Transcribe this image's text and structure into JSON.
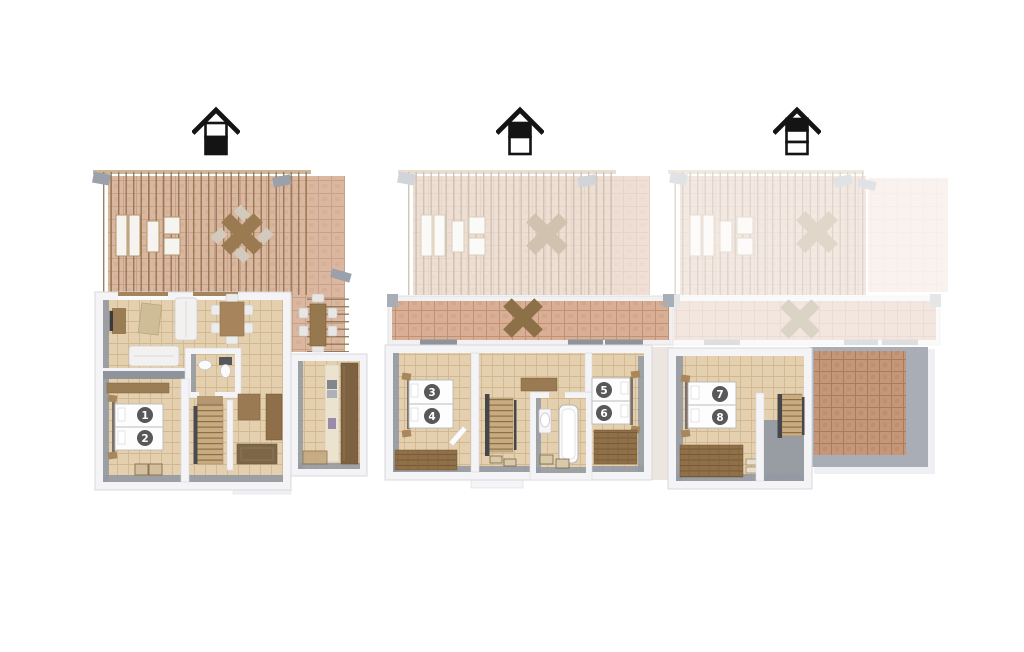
{
  "page": {
    "description": "Three-level 3D floor plan set with numbered beds"
  },
  "colors": {
    "background": "#ffffff",
    "terrace_tile": "#dcb7a0",
    "interior_tile": "#e4d0ae",
    "balcony_tile": "#d8ae94",
    "roof_tile": "#c69678",
    "wall_light": "#f4f4f6",
    "wall_shadow": "#939aa3",
    "wood": "#9a7a52",
    "wood_dark": "#7e6140",
    "pergola": "#8d744e",
    "icon_ink": "#141414",
    "marker_bg": "#58585a",
    "marker_text": "#ffffff"
  },
  "floors": [
    {
      "id": "ground-floor",
      "house_icon": {
        "levels": 2,
        "highlighted_band": "bottom",
        "band_fills": [
          "#ffffff",
          "#141414"
        ]
      },
      "beds": [
        {
          "label": "1"
        },
        {
          "label": "2"
        }
      ],
      "rooms": [
        "terrace",
        "living-room",
        "dining-area",
        "bathroom",
        "bedroom",
        "stairs",
        "hall",
        "kitchen",
        "outdoor-dining"
      ]
    },
    {
      "id": "first-floor",
      "house_icon": {
        "levels": 2,
        "highlighted_band": "top",
        "band_fills": [
          "#141414",
          "#ffffff"
        ]
      },
      "beds": [
        {
          "label": "3"
        },
        {
          "label": "4"
        },
        {
          "label": "5"
        },
        {
          "label": "6"
        }
      ],
      "rooms": [
        "balcony",
        "bedroom-left",
        "stairs",
        "bathroom",
        "bedroom-right"
      ]
    },
    {
      "id": "attic-floor",
      "house_icon": {
        "levels": 3,
        "highlighted_band": "top",
        "band_fills": [
          "#141414",
          "#ffffff",
          "#ffffff"
        ]
      },
      "beds": [
        {
          "label": "7"
        },
        {
          "label": "8"
        }
      ],
      "rooms": [
        "bedroom",
        "stairs",
        "roof-terrace"
      ]
    }
  ]
}
